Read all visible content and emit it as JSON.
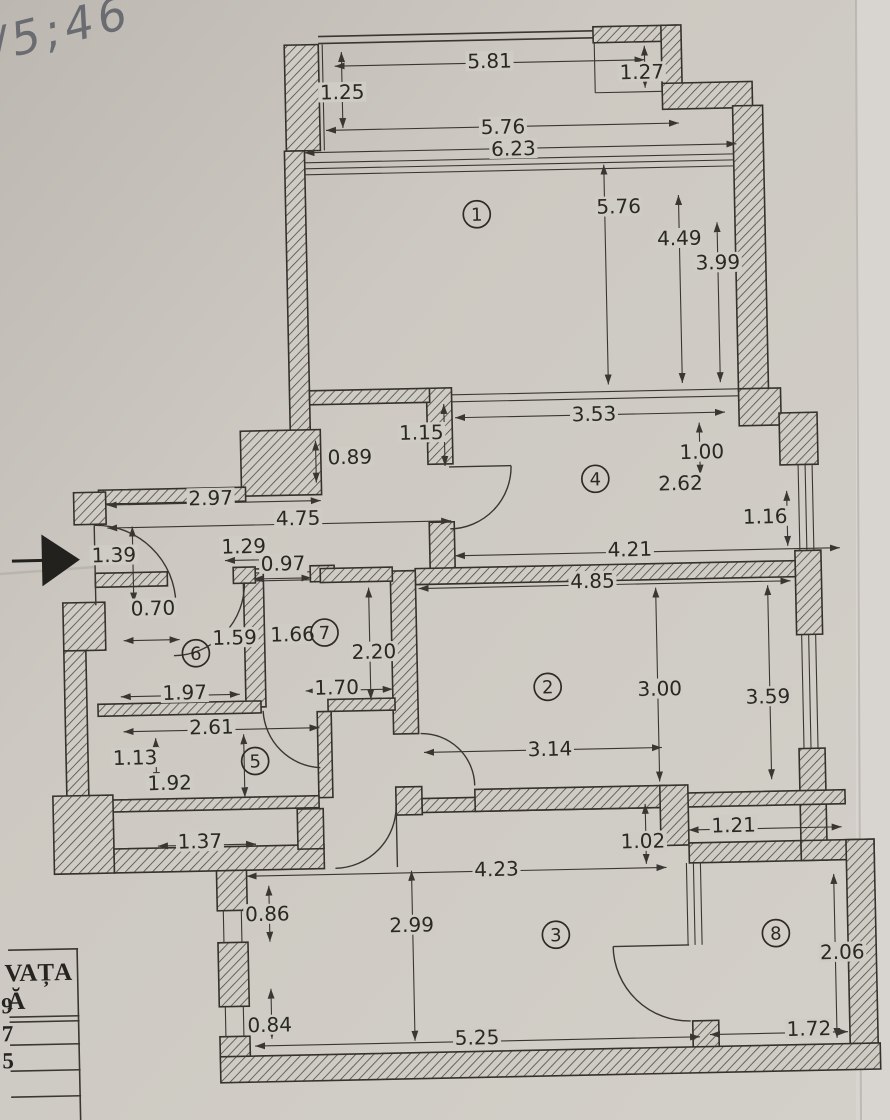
{
  "handwriting": "/5;46",
  "colors": {
    "paper": "#c9c5be",
    "paper_light": "#d8d5d0",
    "ink": "#2e2b27",
    "pencil": "#5c5f66",
    "label_bg": "#cfccc5"
  },
  "entrance": {
    "marker": "entrance-arrow"
  },
  "rooms": [
    {
      "num": "1",
      "x": 484,
      "y": 215
    },
    {
      "num": "2",
      "x": 545,
      "y": 689
    },
    {
      "num": "3",
      "x": 548,
      "y": 937
    },
    {
      "num": "4",
      "x": 597,
      "y": 482
    },
    {
      "num": "5",
      "x": 251,
      "y": 757
    },
    {
      "num": "6",
      "x": 194,
      "y": 648
    },
    {
      "num": "7",
      "x": 323,
      "y": 630
    },
    {
      "num": "8",
      "x": 768,
      "y": 940
    }
  ],
  "dims": [
    {
      "t": "5.81",
      "x": 500,
      "y": 62
    },
    {
      "t": "1.25",
      "x": 352,
      "y": 90
    },
    {
      "t": "1.27",
      "x": 652,
      "y": 76
    },
    {
      "t": "5.76",
      "x": 512,
      "y": 128
    },
    {
      "t": "6.23",
      "x": 522,
      "y": 150
    },
    {
      "t": "5.76",
      "x": 626,
      "y": 210
    },
    {
      "t": "4.49",
      "x": 686,
      "y": 243
    },
    {
      "t": "3.99",
      "x": 724,
      "y": 268
    },
    {
      "t": "1.15",
      "x": 424,
      "y": 432
    },
    {
      "t": "3.53",
      "x": 597,
      "y": 417
    },
    {
      "t": "0.89",
      "x": 352,
      "y": 455
    },
    {
      "t": "1.00",
      "x": 704,
      "y": 457
    },
    {
      "t": "2.62",
      "x": 682,
      "y": 488
    },
    {
      "t": "2.97",
      "x": 212,
      "y": 493
    },
    {
      "t": "4.75",
      "x": 299,
      "y": 515
    },
    {
      "t": "1.16",
      "x": 766,
      "y": 523
    },
    {
      "t": "4.21",
      "x": 630,
      "y": 553
    },
    {
      "t": "1.39",
      "x": 114,
      "y": 548
    },
    {
      "t": "1.29",
      "x": 244,
      "y": 542
    },
    {
      "t": "0.97",
      "x": 283,
      "y": 560
    },
    {
      "t": "4.85",
      "x": 592,
      "y": 584
    },
    {
      "t": "0.70",
      "x": 152,
      "y": 602
    },
    {
      "t": "1.59",
      "x": 233,
      "y": 633
    },
    {
      "t": "1.66",
      "x": 291,
      "y": 631
    },
    {
      "t": "2.20",
      "x": 372,
      "y": 650
    },
    {
      "t": "1.97",
      "x": 182,
      "y": 687
    },
    {
      "t": "1.70",
      "x": 334,
      "y": 685
    },
    {
      "t": "3.00",
      "x": 657,
      "y": 693
    },
    {
      "t": "3.59",
      "x": 765,
      "y": 703
    },
    {
      "t": "2.61",
      "x": 208,
      "y": 722
    },
    {
      "t": "1.13",
      "x": 131,
      "y": 751
    },
    {
      "t": "1.92",
      "x": 165,
      "y": 777
    },
    {
      "t": "3.14",
      "x": 546,
      "y": 751
    },
    {
      "t": "1.37",
      "x": 194,
      "y": 836
    },
    {
      "t": "1.02",
      "x": 637,
      "y": 845
    },
    {
      "t": "1.21",
      "x": 728,
      "y": 831
    },
    {
      "t": "4.23",
      "x": 490,
      "y": 870
    },
    {
      "t": "0.86",
      "x": 260,
      "y": 910
    },
    {
      "t": "2.99",
      "x": 404,
      "y": 924
    },
    {
      "t": "0.84",
      "x": 260,
      "y": 1021
    },
    {
      "t": "5.25",
      "x": 467,
      "y": 1038
    },
    {
      "t": "2.06",
      "x": 834,
      "y": 960
    },
    {
      "t": "1.72",
      "x": 799,
      "y": 1036
    }
  ],
  "legend_table": {
    "header": [
      "VAȚA",
      "Ă"
    ],
    "fragments": [
      {
        "t": "9",
        "y": 1004
      },
      {
        "t": "7",
        "y": 1032
      },
      {
        "t": "5",
        "y": 1059
      }
    ]
  }
}
